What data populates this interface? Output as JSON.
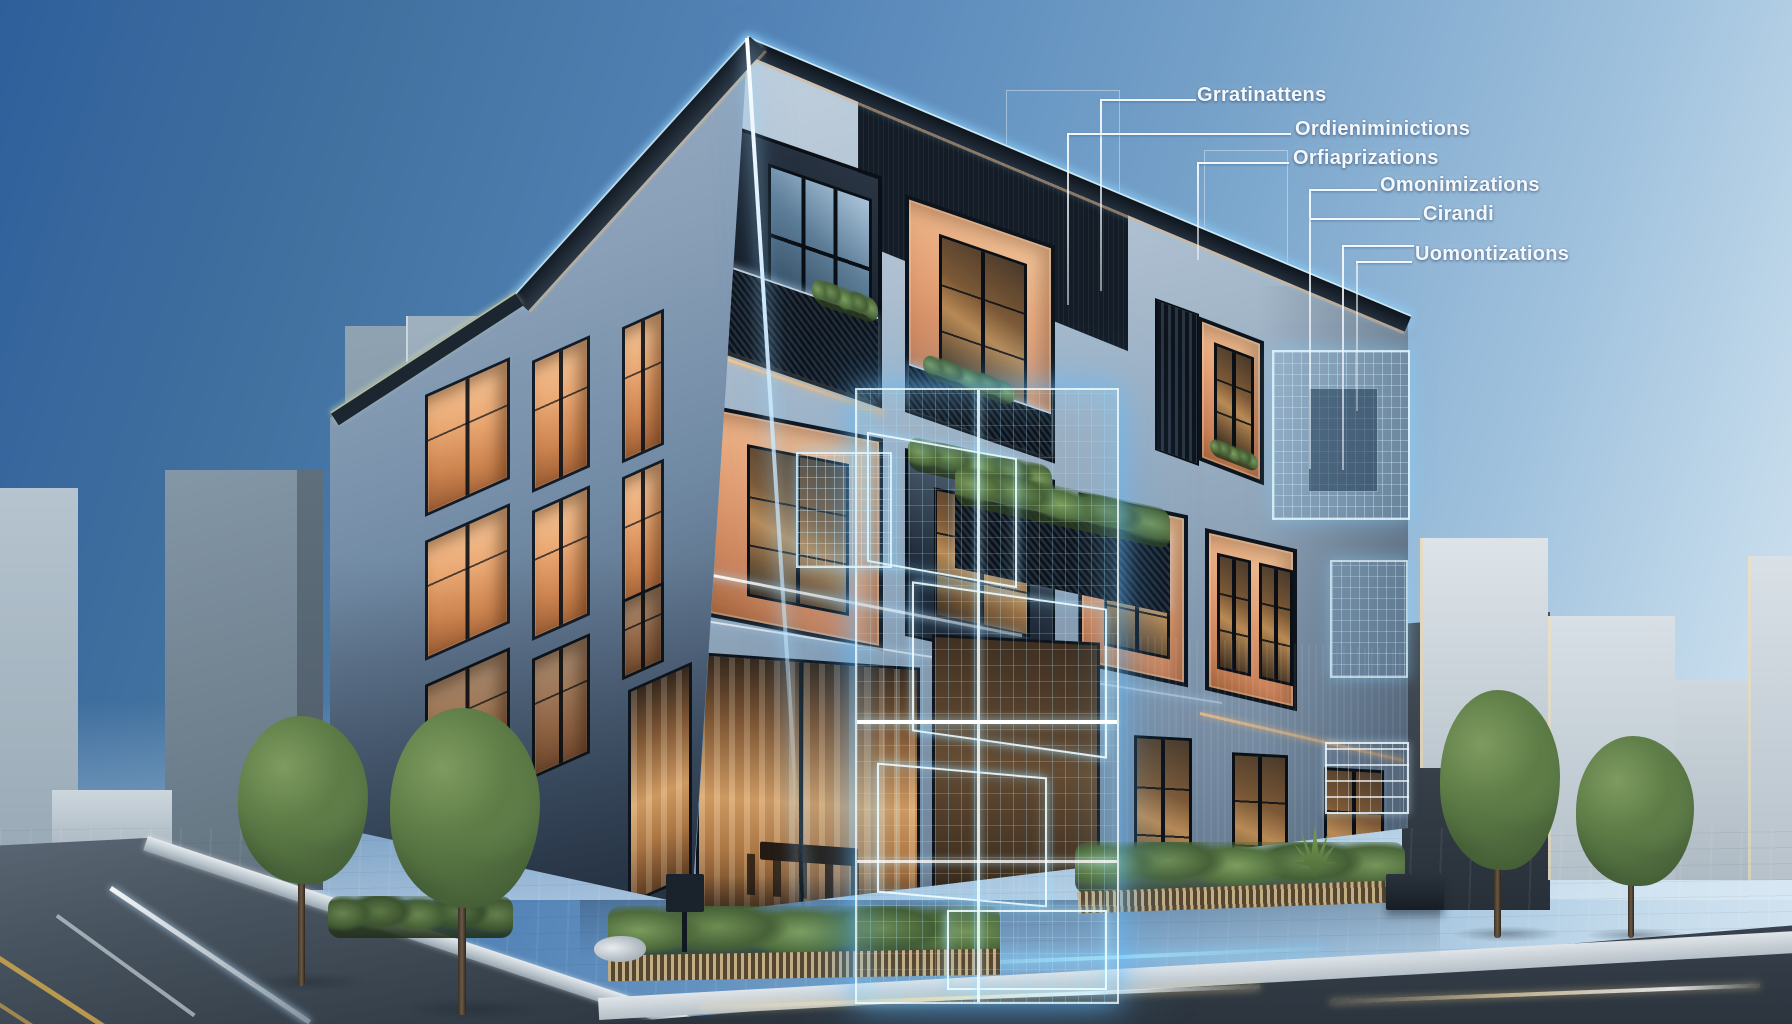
{
  "annotations": [
    {
      "label": "Grratinattens"
    },
    {
      "label": "Ordieniminictions"
    },
    {
      "label": "Orfiaprizations"
    },
    {
      "label": "Omonimizations"
    },
    {
      "label": "Cirandi"
    },
    {
      "label": "Uomontizations"
    }
  ],
  "colors": {
    "sky_top": "#2f5f9b",
    "sky_horizon": "#d3e3f0",
    "facade_light": "#adbfd0",
    "facade_shadow": "#53677f",
    "window_glow_orange": "#eaa873",
    "hologram_cyan": "#63c8ff",
    "roof_trim_amber": "#ffb46a",
    "annotation_text": "#f4f8fc",
    "street_asphalt": "#39444f",
    "foliage_green": "#5d7c46"
  }
}
